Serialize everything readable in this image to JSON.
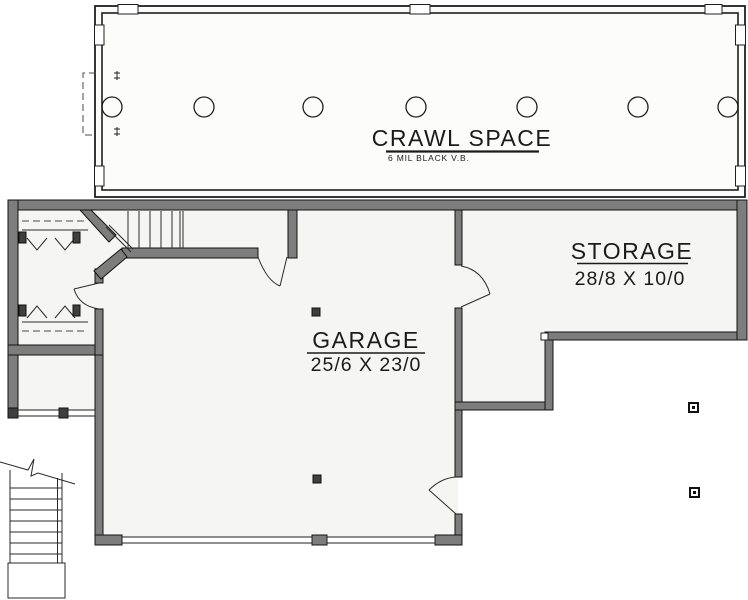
{
  "plan": {
    "rooms": {
      "crawl_space": {
        "name": "CRAWL SPACE",
        "note": "6 MIL BLACK V.B."
      },
      "garage": {
        "name": "GARAGE",
        "dims": "25/6 X 23/0"
      },
      "storage": {
        "name": "STORAGE",
        "dims": "28/8 X 10/0"
      }
    },
    "symbols": {
      "pier_count": 7,
      "stair_runs": 2
    },
    "colors": {
      "wall": "#7d7d7d",
      "ink": "#1b1b1b",
      "floor": "#f5f5f3",
      "background": "#ffffff"
    }
  }
}
